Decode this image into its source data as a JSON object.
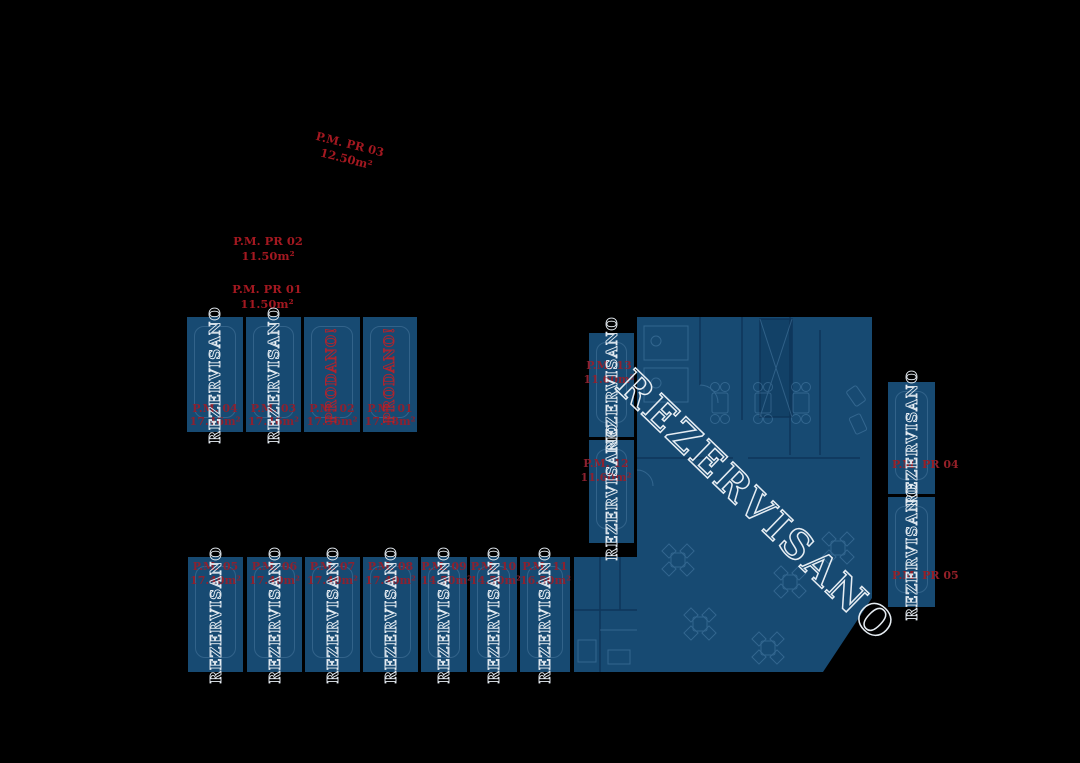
{
  "scene": {
    "title": "garage-parking-plan",
    "colors": {
      "background": "#000000",
      "overlay_blue": "#174a72",
      "reserved_outline": "#e6edf3",
      "sold_red": "#b3232b",
      "label_red": "#8c2130",
      "free_label_red": "#a31820"
    }
  },
  "free_spots": [
    {
      "name": "P.M. PR 03",
      "area": "12.50m²"
    },
    {
      "name": "P.M. PR 02",
      "area": "11.50m²"
    },
    {
      "name": "P.M. PR 01",
      "area": "11.50m²"
    }
  ],
  "stalls": {
    "pm04": {
      "name": "P.M. 04",
      "area": "17.46m²",
      "status": "REZERVISANO"
    },
    "pm03": {
      "name": "P.M. 03",
      "area": "17.46m²",
      "status": "REZERVISANO"
    },
    "pm02": {
      "name": "P.M. 02",
      "area": "17.36m²",
      "status": "PRODANO!"
    },
    "pm01": {
      "name": "P.M. 01",
      "area": "17.48m²",
      "status": "PRODANO!"
    },
    "pm05": {
      "name": "P.M. 05",
      "area": "17.40m²",
      "status": "REZERVISANO"
    },
    "pm06": {
      "name": "P.M. 06",
      "area": "17.40m²",
      "status": "REZERVISANO"
    },
    "pm07": {
      "name": "P.M. 07",
      "area": "17.40m²",
      "status": "REZERVISANO"
    },
    "pm08": {
      "name": "P.M. 08",
      "area": "17.40m²",
      "status": "REZERVISANO"
    },
    "pm09": {
      "name": "P.M. 09",
      "area": "14.50m²",
      "status": "REZERVISANO"
    },
    "pm10": {
      "name": "P.M. 10",
      "area": "14.50m²",
      "status": "REZERVISANO"
    },
    "pm11": {
      "name": "P.M. 11",
      "area": "16.50m²",
      "status": "REZERVISANO"
    },
    "pm13": {
      "name": "P.M. 13",
      "area": "11.60m²",
      "status": "REZERVISANO"
    },
    "pm12": {
      "name": "P.M. 12",
      "area": "11.60m²",
      "status": "REZERVISANO"
    },
    "pr04": {
      "name": "P.M. PR 04",
      "status": "REZERVISANO"
    },
    "pr05": {
      "name": "P.M. PR 05",
      "status": "REZERVISANO"
    }
  },
  "main_area": {
    "status": "REZERVISANO"
  }
}
